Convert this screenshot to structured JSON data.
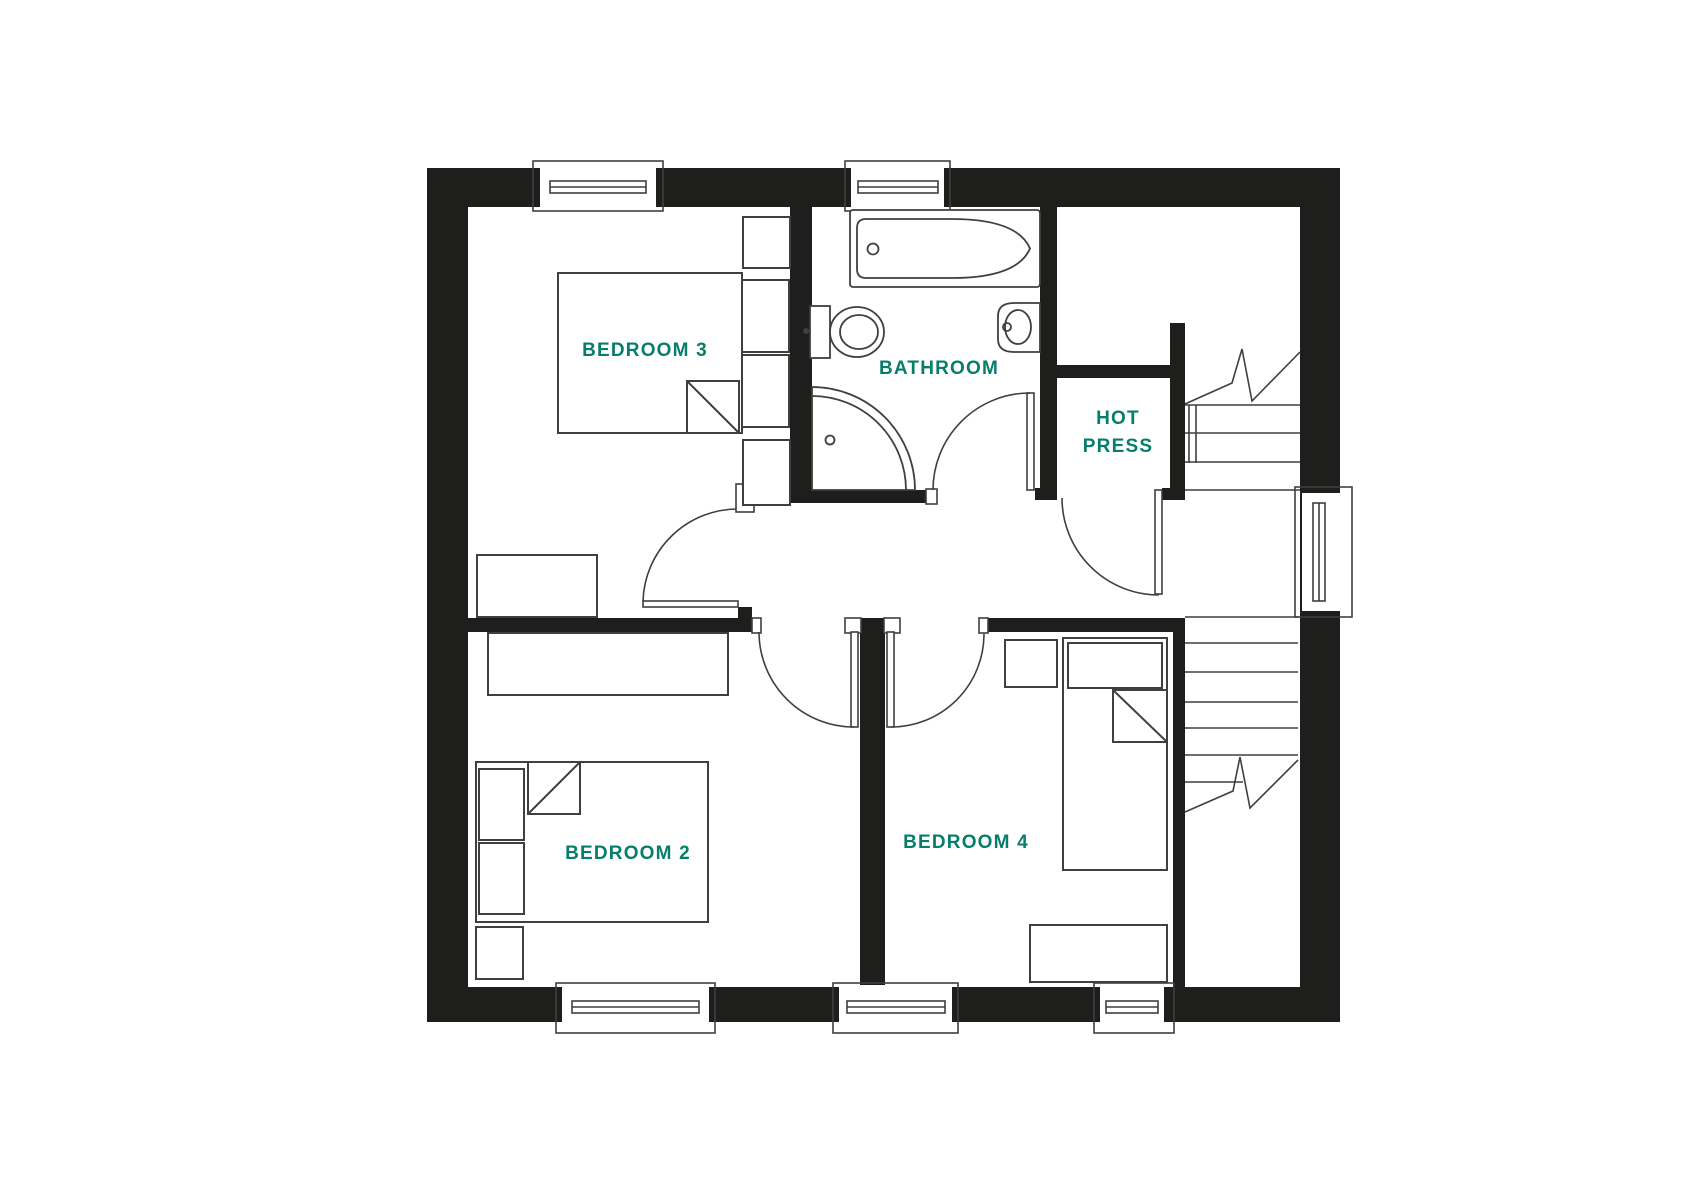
{
  "colors": {
    "wall": "#1e1e1c",
    "line": "#3f3f3d",
    "label": "#077d6b",
    "background": "#ffffff"
  },
  "rooms": {
    "bedroom3": {
      "label": "BEDROOM 3"
    },
    "bathroom": {
      "label": "BATHROOM"
    },
    "hot_press": {
      "line1": "HOT",
      "line2": "PRESS"
    },
    "bedroom2": {
      "label": "BEDROOM 2"
    },
    "bedroom4": {
      "label": "BEDROOM 4"
    }
  }
}
